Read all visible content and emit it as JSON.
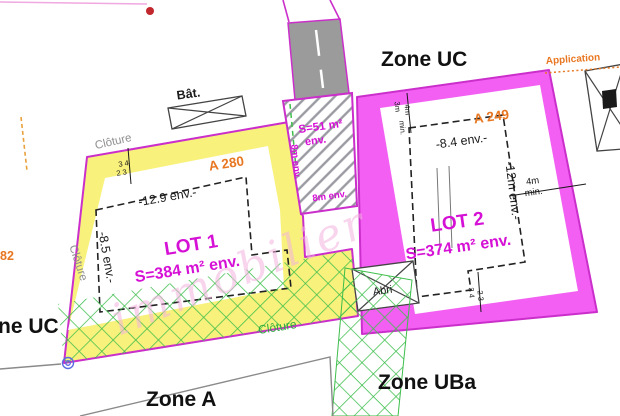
{
  "zones": {
    "top": "Zone UC",
    "left_partial": "ne UC",
    "bottom": "Zone A",
    "bottom_right": "Zone UBa"
  },
  "parcels": {
    "lot1_ref": "A 280",
    "lot2_ref": "A 249",
    "edge_ref_partial": "82"
  },
  "lot1": {
    "name": "LOT 1",
    "area": "S=384 m² env.",
    "width_dim": "-12.9 env.-",
    "depth_dim": "-8.5 env.-",
    "corner_marks": [
      "3 4",
      "2 3"
    ]
  },
  "lot2": {
    "name": "LOT 2",
    "area": "S=374 m² env.",
    "width_dim": "-8.4 env.-",
    "depth_dim": "-12m env.-",
    "setback": [
      "4m",
      "min."
    ],
    "top_marks": [
      "3m",
      "4m",
      "min."
    ],
    "bottom_marks": [
      "3 4",
      "2 3"
    ]
  },
  "access_strip": {
    "area": "S=51 m²",
    "area_suffix": "env.",
    "left_dim": "8m env.",
    "bottom_dim": "8m env."
  },
  "features": {
    "building": "Bât.",
    "shed": "Abri",
    "fence_top": "Clôture",
    "fence_left": "Clôture",
    "fence_bottom": "Clôture",
    "note": "Application"
  },
  "watermark": "immobilier",
  "colors": {
    "lot1_fill": "#F8F17B",
    "lot2_fill": "#F25FF2",
    "parcel_border": "#CB2FCB",
    "lot_text": "#D611D6",
    "ref_text": "#E87722",
    "fence_green": "#2FAE3E",
    "road_gray": "#9B9B9B",
    "marker_blue": "#5B6BE0",
    "dot_red": "#C1272D"
  }
}
